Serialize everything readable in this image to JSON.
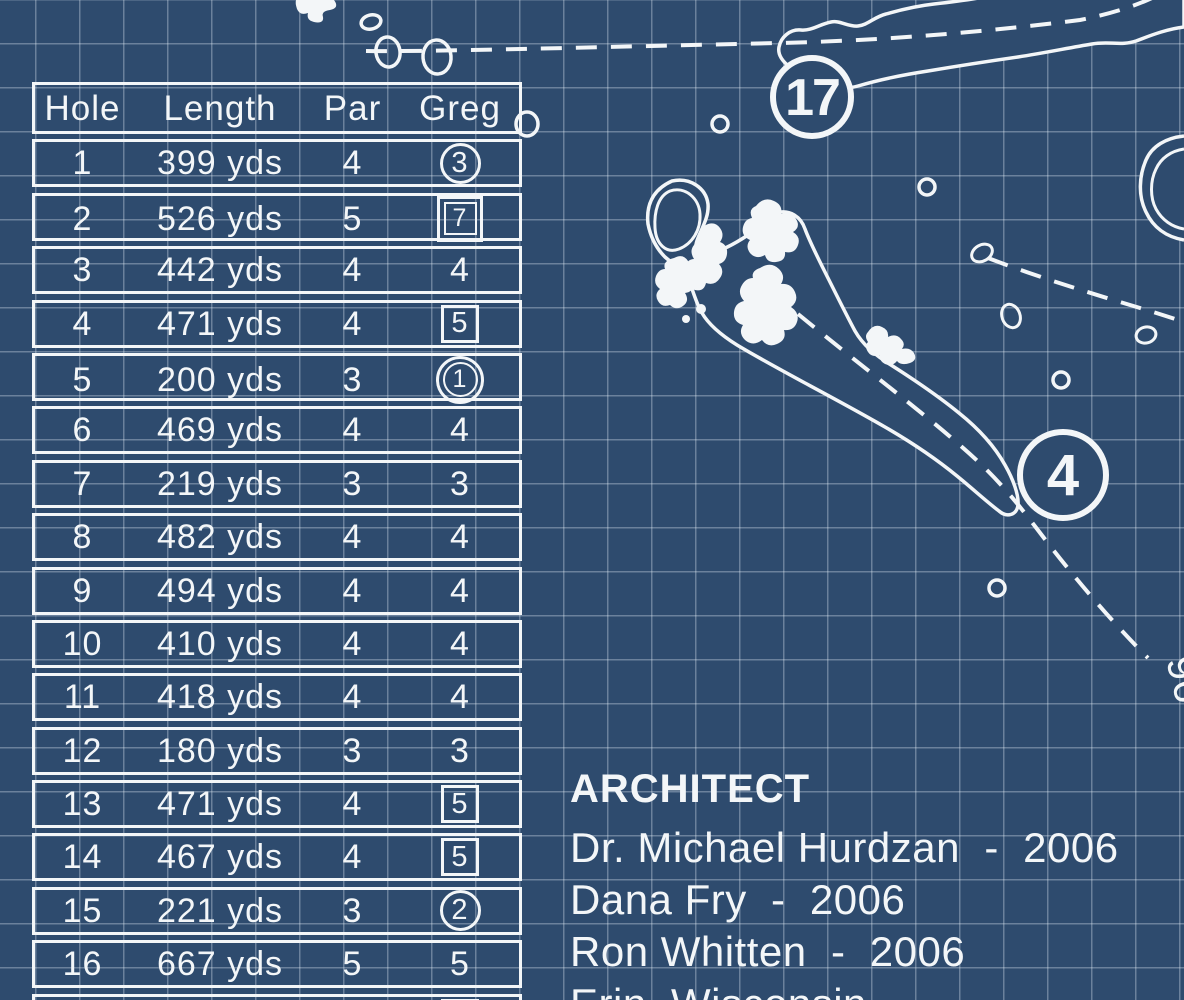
{
  "table": {
    "headers": [
      "Hole",
      "Length",
      "Par",
      "Greg"
    ],
    "rows": [
      {
        "hole": "1",
        "length": "399 yds",
        "par": "4",
        "greg": "3",
        "mark": "circle"
      },
      {
        "hole": "2",
        "length": "526 yds",
        "par": "5",
        "greg": "7",
        "mark": "double-square"
      },
      {
        "hole": "3",
        "length": "442 yds",
        "par": "4",
        "greg": "4",
        "mark": "none"
      },
      {
        "hole": "4",
        "length": "471 yds",
        "par": "4",
        "greg": "5",
        "mark": "square"
      },
      {
        "hole": "5",
        "length": "200 yds",
        "par": "3",
        "greg": "1",
        "mark": "double-circle"
      },
      {
        "hole": "6",
        "length": "469 yds",
        "par": "4",
        "greg": "4",
        "mark": "none"
      },
      {
        "hole": "7",
        "length": "219 yds",
        "par": "3",
        "greg": "3",
        "mark": "none"
      },
      {
        "hole": "8",
        "length": "482 yds",
        "par": "4",
        "greg": "4",
        "mark": "none"
      },
      {
        "hole": "9",
        "length": "494 yds",
        "par": "4",
        "greg": "4",
        "mark": "none"
      },
      {
        "hole": "10",
        "length": "410 yds",
        "par": "4",
        "greg": "4",
        "mark": "none"
      },
      {
        "hole": "11",
        "length": "418 yds",
        "par": "4",
        "greg": "4",
        "mark": "none"
      },
      {
        "hole": "12",
        "length": "180 yds",
        "par": "3",
        "greg": "3",
        "mark": "none"
      },
      {
        "hole": "13",
        "length": "471 yds",
        "par": "4",
        "greg": "5",
        "mark": "square"
      },
      {
        "hole": "14",
        "length": "467 yds",
        "par": "4",
        "greg": "5",
        "mark": "square"
      },
      {
        "hole": "15",
        "length": "221 yds",
        "par": "3",
        "greg": "2",
        "mark": "circle"
      },
      {
        "hole": "16",
        "length": "667 yds",
        "par": "5",
        "greg": "5",
        "mark": "none"
      },
      {
        "hole": "",
        "length": "",
        "par": "",
        "greg": "",
        "mark": "square"
      }
    ]
  },
  "architect": {
    "heading": "ARCHITECT",
    "lines": [
      "Dr. Michael Hurdzan  -  2006",
      "Dana Fry  -  2006",
      "Ron Whitten  -  2006",
      "Erin, Wisconsin"
    ]
  },
  "map": {
    "hole_marker_17": "17",
    "hole_marker_4": "4",
    "yardage_label": "96"
  },
  "colors": {
    "background": "#2e4b6e",
    "line": "#f3f6f8",
    "grid": "rgba(230,240,248,0.33)"
  }
}
